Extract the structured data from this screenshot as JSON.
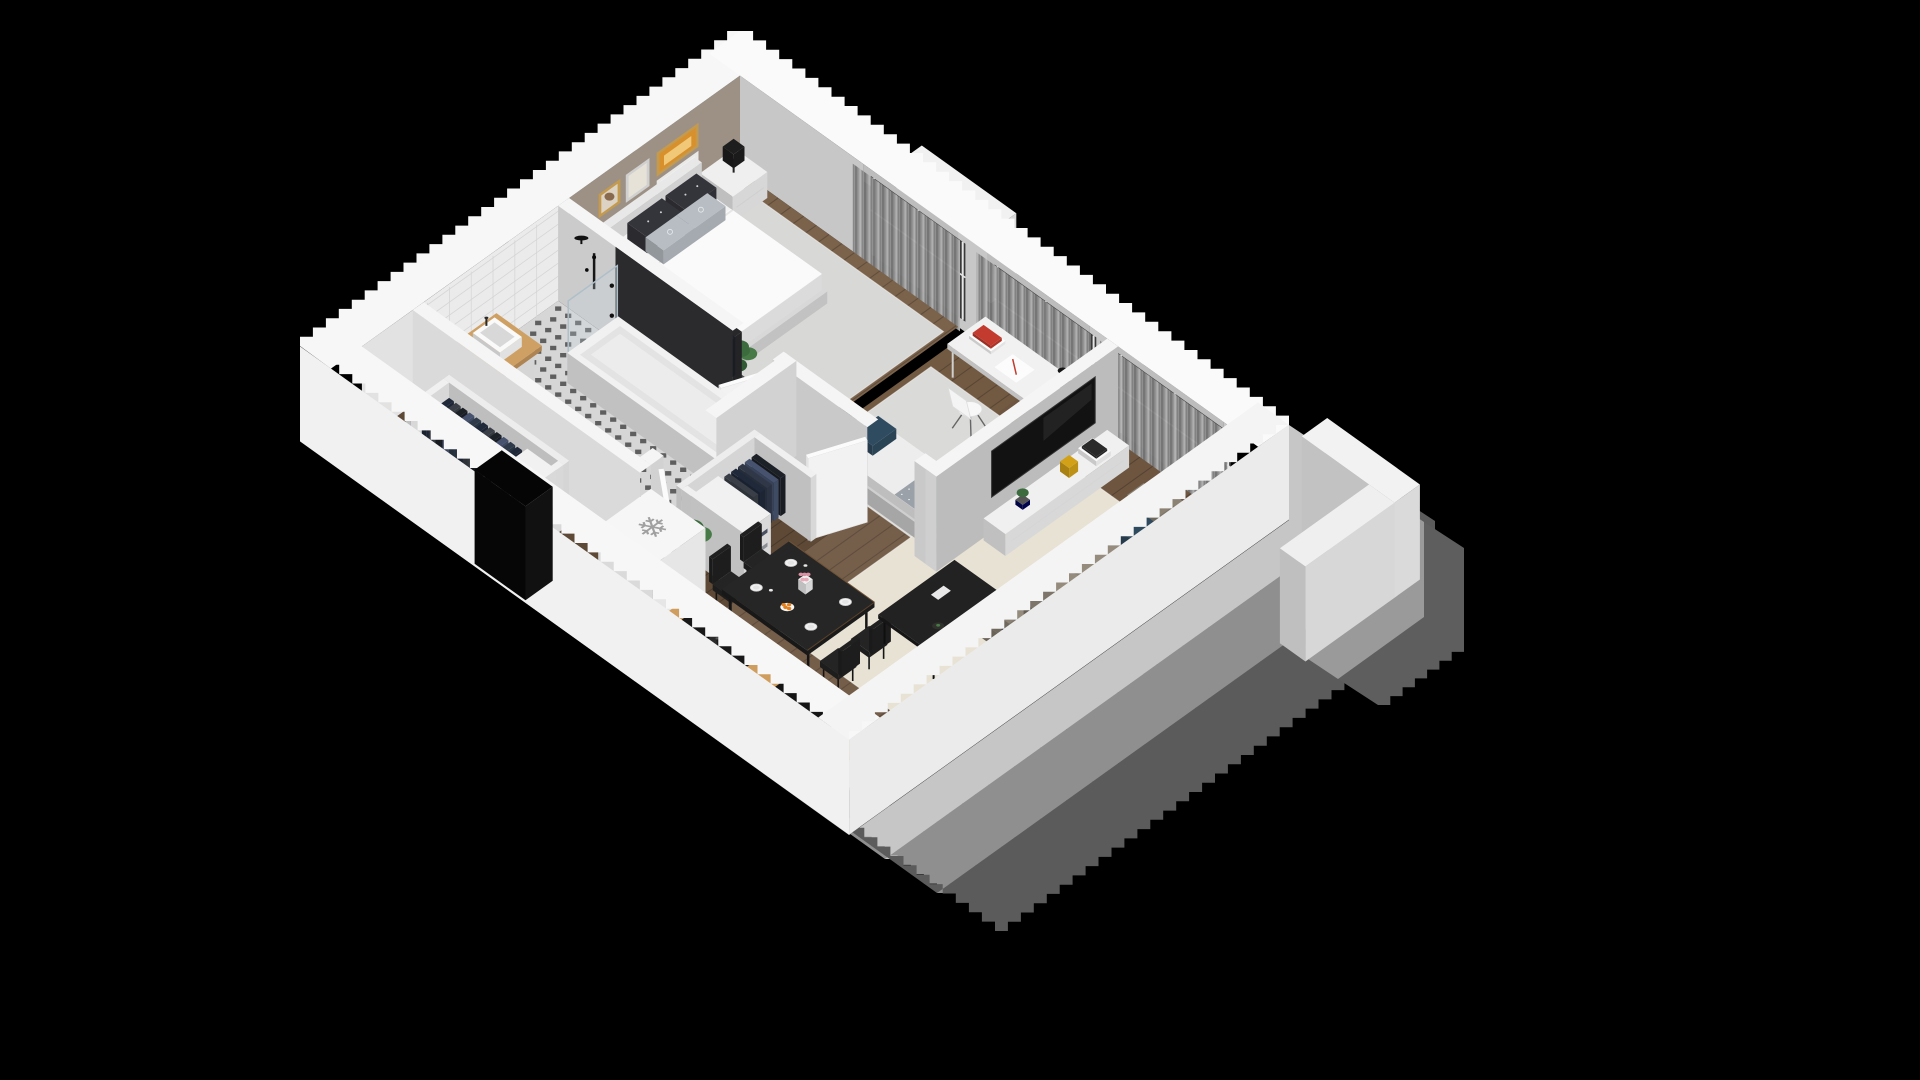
{
  "scene": {
    "label": "Isometric 3D apartment floor plan render on black background",
    "background": "#000000",
    "canvas": {
      "w": 1920,
      "h": 1080
    }
  },
  "projection": {
    "ox": 740,
    "oy": 155,
    "ax": 0.909,
    "ay": 0.651,
    "wall_height": 95,
    "pixel_step": 13
  },
  "building": {
    "w": 560,
    "d": 440,
    "shell": 22
  },
  "icons": {
    "freezer_icon": "❄"
  },
  "palette": {
    "roof_cap": "#f7f7f7",
    "outer_wall_bright": "#f1f1f1",
    "outer_wall": "#ebebeb",
    "inner_wall_gray": "#c7c7c7",
    "accent_wall_taupe": "#9d9186",
    "tile_wall": "#ebebeb",
    "wood_dark": "#5e4936",
    "wood_mid": "#6d5540",
    "wood_bed": "#7a624b",
    "rug_cream": "#e7e2d4",
    "rug_gray": "#d8d8d6",
    "tile_floor": "#d6d6d6",
    "sofa_taupe": "#8b8274",
    "navy_pillow": "#2e4a5e",
    "dining_black": "#1e1e1e",
    "counter_wood": "#cf9e5e",
    "art_orange": "#d8902c",
    "frame_gold": "#c49a4e",
    "shadow_1": "#c6c6c6",
    "shadow_2": "#8f8f8f",
    "shadow_3": "#5b5b5b"
  },
  "rooms": [
    {
      "name": "bedroom",
      "label": "Bedroom"
    },
    {
      "name": "bathroom",
      "label": "Bathroom"
    },
    {
      "name": "hallway",
      "label": "Hallway / Entry"
    },
    {
      "name": "office-bedroom",
      "label": "Second bedroom / Office"
    },
    {
      "name": "living-kitchen",
      "label": "Living room / Kitchen / Dining"
    }
  ],
  "items": [
    {
      "name": "building-shadow",
      "type": "shadow",
      "chain": [
        [
          1289,
          425
        ],
        [
          1289,
          520
        ],
        [
          849,
          835
        ],
        [
          300,
          441
        ]
      ],
      "bands": [
        {
          "dx": 36,
          "dy": 24,
          "fill": "#c6c6c6"
        },
        {
          "dx": 52,
          "dy": 34,
          "fill": "#8f8f8f"
        },
        {
          "dx": 58,
          "dy": 38,
          "fill": "#5b5b5b"
        }
      ]
    },
    {
      "name": "parapet-shadow",
      "type": "shadow",
      "chain": [
        [
          1394,
          502
        ],
        [
          1394,
          597
        ],
        [
          1308,
          659
        ]
      ],
      "bands": [
        {
          "dx": 30,
          "dy": 20,
          "fill": "#9a9a9a"
        },
        {
          "dx": 40,
          "dy": 26,
          "fill": "#5e5e5e"
        }
      ]
    },
    {
      "name": "balcony-parapet-wall-a",
      "type": "box",
      "r": [
        598,
        -48,
        700,
        -20
      ],
      "z": [
        0,
        95
      ],
      "c": "#f2f2f2"
    },
    {
      "name": "balcony-parapet-wall-b",
      "type": "box",
      "r": [
        672,
        -20,
        700,
        78
      ],
      "z": [
        0,
        95
      ],
      "c": "#efefef"
    },
    {
      "name": "bedroom-window-ledge",
      "type": "box",
      "r": [
        148,
        -52,
        252,
        -24
      ],
      "z": [
        0,
        72
      ],
      "c": "#f1f1f1"
    },
    {
      "name": "exterior-wall-windows",
      "type": "wallY",
      "at": 12,
      "segs": [
        [
          12,
          148
        ],
        [
          252,
          284
        ],
        [
          396,
          420
        ],
        [
          544,
          548
        ]
      ],
      "fill": "#c7c7c7",
      "lintels": [
        [
          148,
          252
        ],
        [
          284,
          396
        ],
        [
          420,
          544
        ]
      ]
    },
    {
      "name": "window-glass-bedroom",
      "type": "glass",
      "x": [
        148,
        252
      ]
    },
    {
      "name": "window-glass-office",
      "type": "glass",
      "x": [
        284,
        396
      ]
    },
    {
      "name": "window-glass-living",
      "type": "glass",
      "x": [
        420,
        544
      ]
    },
    {
      "name": "curtains-bedroom",
      "type": "curtain",
      "x": [
        140,
        258
      ]
    },
    {
      "name": "curtains-office",
      "type": "curtain",
      "x": [
        276,
        402
      ]
    },
    {
      "name": "curtains-living",
      "type": "curtain",
      "x": [
        412,
        552
      ]
    },
    {
      "name": "bedroom-accent-wall",
      "type": "wallX",
      "at": 12,
      "segs": [
        [
          12,
          200
        ]
      ],
      "fill": "#9d9186"
    },
    {
      "name": "bedroom-wall-art",
      "type": "pictures"
    },
    {
      "name": "bathroom-tiled-wall",
      "type": "wallX",
      "at": 12,
      "segs": [
        [
          200,
          360
        ]
      ],
      "fill": "#ebebeb",
      "grid": true
    },
    {
      "name": "entry-back-wall",
      "type": "wallX",
      "at": 12,
      "segs": [
        [
          360,
          428
        ]
      ],
      "fill": "#e2e2e2"
    },
    {
      "name": "roof-cap-back-left",
      "type": "capA"
    },
    {
      "name": "roof-cap-back-right",
      "type": "capB"
    },
    {
      "name": "bedroom-floor",
      "type": "floor",
      "rects": [
        [
          12,
          12,
          252,
          200
        ]
      ],
      "fill": "#7a624b",
      "planks": 14
    },
    {
      "name": "office-floor",
      "type": "floor",
      "rects": [
        [
          262,
          12,
          416,
          200
        ]
      ],
      "fill": "#715942",
      "planks": 14
    },
    {
      "name": "bathroom-floor",
      "type": "tilefloor",
      "r": [
        12,
        212,
        250,
        360
      ],
      "base": "#d6d6d6",
      "dot": "#303030",
      "step": 11
    },
    {
      "name": "hallway-floor",
      "type": "floor",
      "rects": [
        [
          262,
          212,
          340,
          372
        ],
        [
          12,
          372,
          262,
          428
        ]
      ],
      "fill": "#5e4936",
      "planks": 14
    },
    {
      "name": "living-floor",
      "type": "floor",
      "rects": [
        [
          340,
          12,
          548,
          428
        ],
        [
          262,
          372,
          340,
          428
        ]
      ],
      "fill": "#6d5540",
      "planks": 14
    },
    {
      "name": "sunlight-patch",
      "type": "patch",
      "r": [
        340,
        140,
        540,
        330
      ],
      "fill": "rgba(255,255,255,0.055)"
    },
    {
      "name": "kitchen-light-patch",
      "type": "patch",
      "r": [
        340,
        340,
        548,
        428
      ],
      "fill": "rgba(255,255,255,0.05)"
    },
    {
      "name": "bedroom-rug",
      "type": "rug",
      "r": [
        28,
        24,
        248,
        196
      ],
      "fill": "#d8d8d6"
    },
    {
      "name": "office-rug",
      "type": "rug",
      "r": [
        268,
        58,
        414,
        200
      ],
      "fill": "#dadad8"
    },
    {
      "name": "living-rug",
      "type": "rug",
      "r": [
        388,
        58,
        546,
        344
      ],
      "fill": "#e7e2d4"
    },
    {
      "name": "nightstand-window-side",
      "type": "nightstand",
      "r": [
        12,
        18,
        48,
        56
      ],
      "lamp": true
    },
    {
      "name": "double-bed",
      "type": "bed"
    },
    {
      "name": "nightstand-closet-side",
      "type": "nightstand",
      "r": [
        12,
        170,
        48,
        198
      ],
      "lamp": false
    },
    {
      "name": "bedroom-plant",
      "type": "plant",
      "at": [
        178,
        178
      ],
      "s": 9,
      "h": 40
    },
    {
      "name": "bedroom-clothes-rack",
      "type": "wardrobe",
      "boxes": [
        {
          "r": [
            58,
            190,
            192,
            200
          ],
          "z": [
            0,
            72
          ],
          "c": "#28282b"
        }
      ],
      "rail": {
        "p1": [
          64,
          193,
          62
        ],
        "p2": [
          186,
          193,
          62
        ]
      },
      "clothes": {
        "dir": "x",
        "from": 64,
        "to": 182,
        "step": 7.5,
        "lo": 187,
        "hi": 198,
        "z": [
          20,
          58
        ],
        "colors": [
          "#20293a",
          "#303848",
          "#3a3f47",
          "#1c2027",
          "#46526e",
          "#22252c"
        ]
      }
    },
    {
      "name": "office-desk",
      "type": "desk"
    },
    {
      "name": "office-chair",
      "type": "shellchair",
      "at": [
        337,
        84
      ]
    },
    {
      "name": "office-daybed",
      "type": "daybed"
    },
    {
      "name": "bedroom-hall-wall",
      "type": "wallY",
      "at": 212,
      "segs": [
        [
          12,
          75
        ],
        [
          248,
          252
        ]
      ],
      "fill": "#cbcbcb",
      "caps": [
        [
          12,
          200,
          204,
          212
        ],
        [
          248,
          200,
          252,
          212
        ]
      ]
    },
    {
      "name": "bathtub-niche-panel",
      "type": "wallY",
      "at": 212,
      "segs": [
        [
          75,
          204
        ]
      ],
      "fill": "#2b2b2e"
    },
    {
      "name": "shower-fixtures",
      "type": "showerset"
    },
    {
      "name": "bedroom-door",
      "type": "doorleaf",
      "h": [
        248,
        212
      ],
      "ang": 112,
      "len": 44
    },
    {
      "name": "office-hall-wall",
      "type": "wallY",
      "at": 212,
      "segs": [
        [
          262,
          352
        ],
        [
          404,
          428
        ]
      ],
      "fill": "#c9c9c9",
      "caps": [
        [
          262,
          200,
          352,
          212
        ],
        [
          404,
          200,
          428,
          212
        ]
      ]
    },
    {
      "name": "office-door",
      "type": "doorleaf",
      "h": [
        352,
        212
      ],
      "ang": 112,
      "len": 50
    },
    {
      "name": "office-living-wall",
      "type": "wallX",
      "at": 428,
      "segs": [
        [
          12,
          212
        ]
      ],
      "fill": "#bcbcbc",
      "caps": [
        [
          416,
          12,
          428,
          212
        ]
      ],
      "end": [
        416,
        428,
        212
      ]
    },
    {
      "name": "wall-mounted-tv",
      "type": "tv"
    },
    {
      "name": "tv-console",
      "type": "console"
    },
    {
      "name": "shower-glass",
      "type": "showerglass"
    },
    {
      "name": "bathtub",
      "type": "tub"
    },
    {
      "name": "bathroom-sink-counter",
      "type": "sinkcounter"
    },
    {
      "name": "washing-machine",
      "type": "washer"
    },
    {
      "name": "bathroom-hall-wall",
      "type": "wallX",
      "at": 262,
      "segs": [
        [
          200,
          288
        ],
        [
          346,
          360
        ]
      ],
      "fill": "#d2d2d2",
      "caps": [
        [
          250,
          200,
          262,
          288
        ],
        [
          250,
          346,
          262,
          360
        ]
      ]
    },
    {
      "name": "bathroom-door",
      "type": "doorleaf",
      "h": [
        262,
        346
      ],
      "ang": 38,
      "len": 50
    },
    {
      "name": "bathroom-entry-wall",
      "type": "wallY",
      "at": 372,
      "segs": [
        [
          12,
          262
        ]
      ],
      "fill": "#dadada",
      "caps": [
        [
          12,
          360,
          262,
          372
        ]
      ]
    },
    {
      "name": "hallway-wardrobe",
      "type": "wardrobe",
      "boxes": [
        {
          "r": [
            268,
            252,
            274,
            338
          ],
          "z": [
            0,
            64
          ],
          "c": "#ededed"
        },
        {
          "r": [
            274,
            252,
            336,
            258
          ],
          "z": [
            0,
            64
          ],
          "c": "#f0f0f0"
        },
        {
          "r": [
            274,
            332,
            336,
            338
          ],
          "z": [
            0,
            64
          ],
          "c": "#f0f0f0"
        }
      ],
      "clothes": {
        "dir": "y",
        "from": 262,
        "to": 298,
        "step": 7.5,
        "lo": 280,
        "hi": 312,
        "z": [
          16,
          54
        ],
        "colors": [
          "#1c2027",
          "#46526e",
          "#303848",
          "#20293a",
          "#3a3f47"
        ]
      },
      "shelf": {
        "r": [
          276,
          300,
          334,
          330
        ],
        "face": "x",
        "z1": 54,
        "folded": [
          "#6a7687",
          "#8a8f96",
          "#4a5261"
        ]
      }
    },
    {
      "name": "hallway-plant",
      "type": "plant",
      "at": [
        300,
        352
      ],
      "s": 11,
      "h": 52
    },
    {
      "name": "entry-wardrobe",
      "type": "wardrobe",
      "boxes": [
        {
          "r": [
            58,
            378,
            190,
            384
          ],
          "z": [
            0,
            64
          ],
          "c": "#ededed"
        },
        {
          "r": [
            58,
            384,
            64,
            426
          ],
          "z": [
            0,
            64
          ],
          "c": "#f0f0f0"
        },
        {
          "r": [
            184,
            384,
            190,
            426
          ],
          "z": [
            0,
            64
          ],
          "c": "#f0f0f0"
        }
      ],
      "clothes": {
        "dir": "x",
        "from": 68,
        "to": 148,
        "step": 7.5,
        "lo": 388,
        "hi": 418,
        "z": [
          16,
          54
        ],
        "colors": [
          "#20293a",
          "#3a3f47",
          "#1c2027",
          "#46526e",
          "#2e3a4a"
        ]
      },
      "shelf": {
        "r": [
          150,
          384,
          182,
          424
        ],
        "face": "y",
        "z1": 54,
        "folded": [
          "#9aa4ae",
          "#4a5261",
          "#8a8f96"
        ]
      }
    },
    {
      "name": "entry-plant",
      "type": "plant",
      "at": [
        150,
        410
      ],
      "s": 7,
      "h": 26
    },
    {
      "name": "refrigerator",
      "type": "fridge",
      "r": [
        272,
        370,
        332,
        428
      ],
      "z": [
        0,
        84
      ]
    },
    {
      "name": "dining-chair-1",
      "type": "dchair",
      "at": [
        330,
        306
      ],
      "back": "lo"
    },
    {
      "name": "dining-chair-2",
      "type": "dchair",
      "at": [
        330,
        340
      ],
      "back": "lo"
    },
    {
      "name": "dining-table",
      "type": "dtable"
    },
    {
      "name": "dining-chair-3",
      "type": "dchair",
      "at": [
        448,
        306
      ],
      "back": "hi"
    },
    {
      "name": "dining-chair-4",
      "type": "dchair",
      "at": [
        448,
        340
      ],
      "back": "hi"
    },
    {
      "name": "sofa",
      "type": "sofa"
    },
    {
      "name": "coffee-table",
      "type": "ctable"
    },
    {
      "name": "kitchen-counter",
      "type": "kcounter"
    },
    {
      "name": "exterior-wall-front-left",
      "type": "shellD"
    },
    {
      "name": "entrance-doorway",
      "type": "box",
      "r": [
        168,
        430,
        224,
        460
      ],
      "z": [
        0,
        94
      ],
      "c": "#0a0a0a",
      "ct": "#050505",
      "cx": "#111111",
      "cy": "#060606"
    },
    {
      "name": "exterior-wall-front-right",
      "type": "shellC"
    }
  ]
}
